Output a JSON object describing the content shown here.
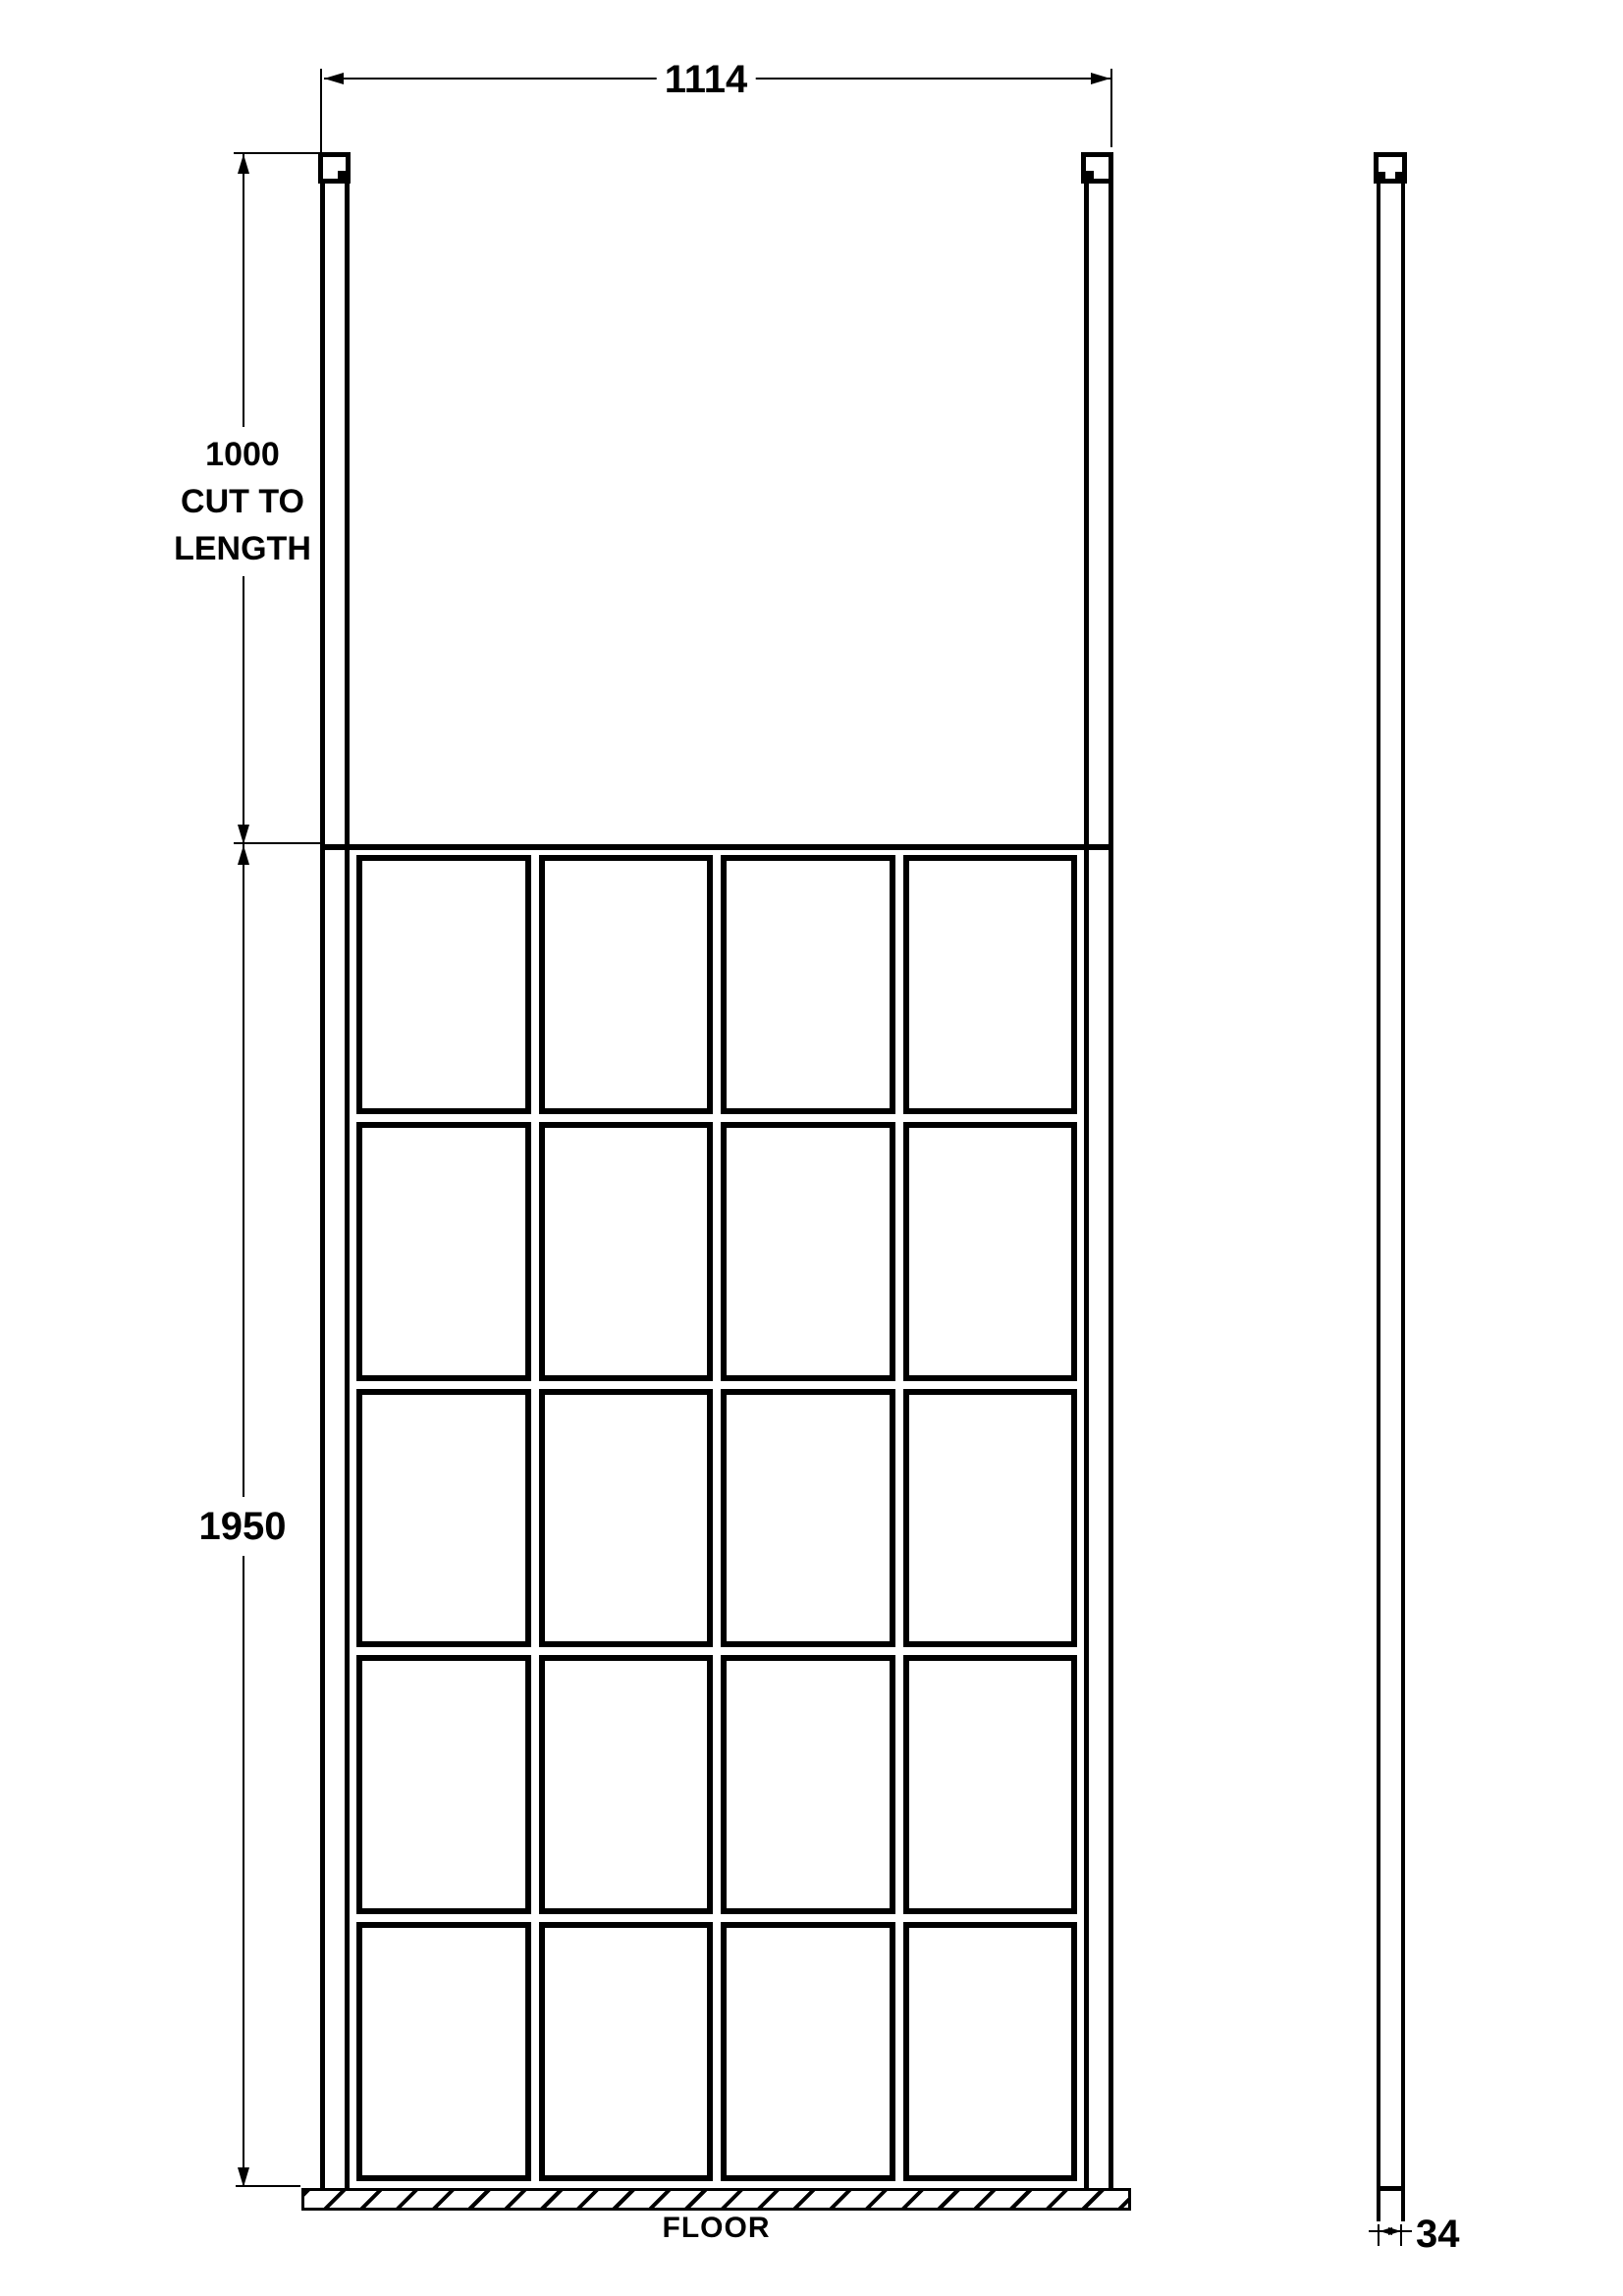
{
  "drawing": {
    "type": "technical-elevation",
    "subject": "walk-in shower screen with two ceiling posts, front and side views"
  },
  "dimensions": {
    "width": {
      "value": "1114"
    },
    "post": {
      "value": "1000",
      "note_line1": "CUT TO",
      "note_line2": "LENGTH"
    },
    "height": {
      "value": "1950"
    },
    "thickness": {
      "value": "34"
    }
  },
  "labels": {
    "floor": "FLOOR"
  },
  "grid": {
    "columns": 4,
    "rows": 5,
    "pane_count": 20
  },
  "colors": {
    "line": "#000000",
    "background": "#ffffff"
  }
}
